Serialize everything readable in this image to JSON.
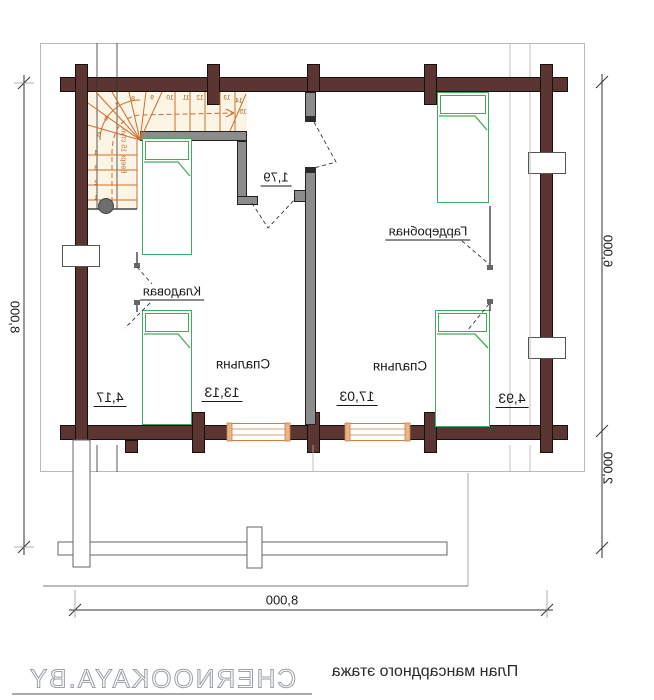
{
  "document": {
    "title": "План мансардного этажа",
    "watermark": "CHERNOOKAYA.BY"
  },
  "rooms": {
    "bedroom_left": {
      "name": "Спальня",
      "area": "13,13"
    },
    "bedroom_right": {
      "name": "Спальня",
      "area": "17,03"
    },
    "storage": {
      "name": "Кладовая",
      "area": "4,17"
    },
    "wardrobe": {
      "name": "Гардеробная",
      "area": "4,93"
    },
    "hall": {
      "area": "1,79"
    }
  },
  "dimensions": {
    "overall_width_bottom": "8,000",
    "overall_height_left": "8,000",
    "house_depth_right": "6,000",
    "terrace_depth_right": "2,000"
  },
  "stairs": {
    "note": "Вверх 15 ступ.",
    "steps": [
      "1",
      "2",
      "3",
      "4",
      "5",
      "6",
      "7",
      "8",
      "9",
      "10",
      "11",
      "12",
      "13",
      "14",
      "15"
    ]
  },
  "colors": {
    "log_wall": "#5a3531",
    "partition": "#8c8c8c",
    "stair_lines": "#c96f2e",
    "bed_outline": "#3fae5a",
    "window_frame": "#cd7f43",
    "dimension_text": "#1a1a1a",
    "watermark": "#9aa0a6"
  }
}
